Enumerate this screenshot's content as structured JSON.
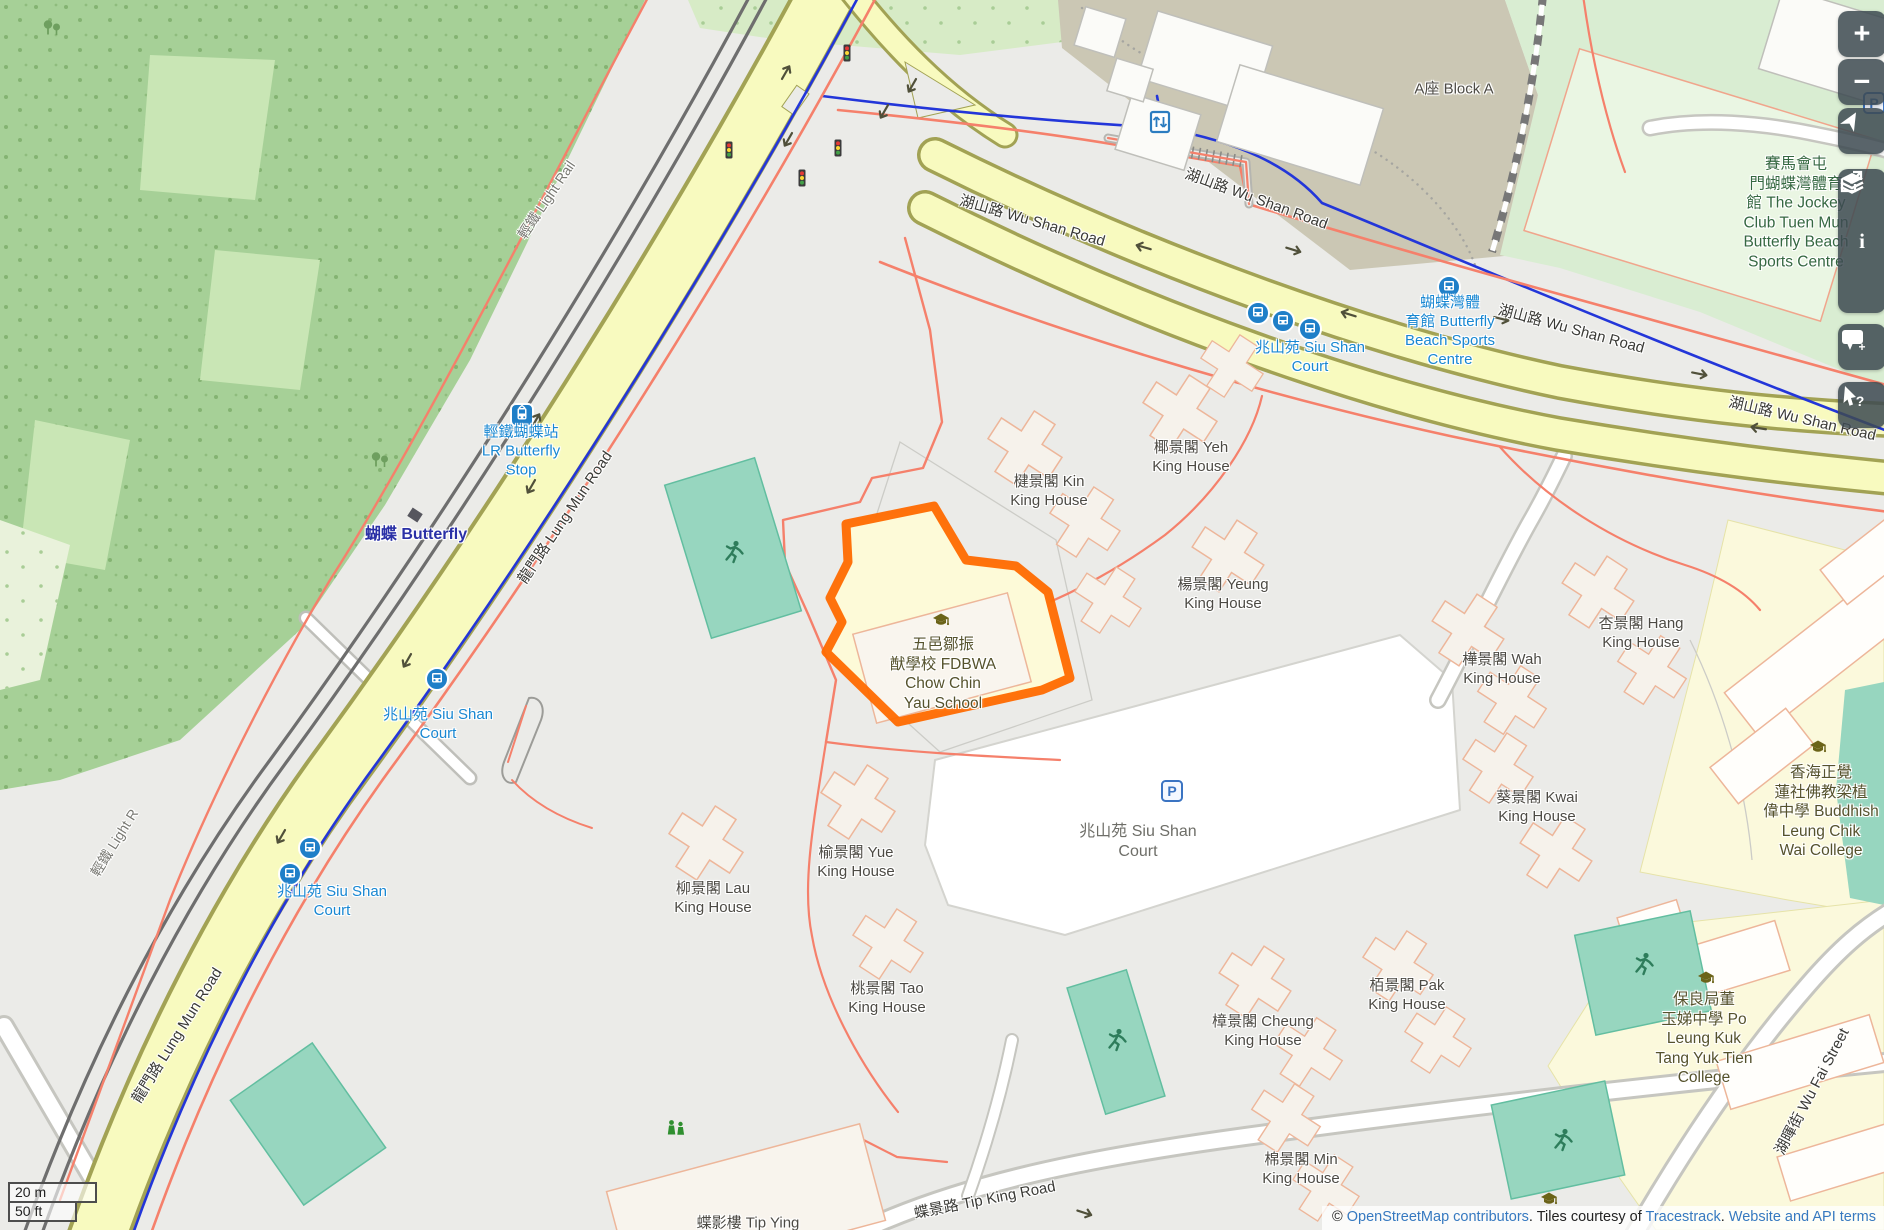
{
  "theme": {
    "transit-blue": "#1887D2",
    "link-blue": "#3679C0",
    "highlight-orange": "#FF6A00",
    "road-yellow": "#F8FABF",
    "pitch-teal": "#97D6BF"
  },
  "controls": {
    "zoom_in": "+",
    "zoom_out": "−",
    "info_glyph": "i",
    "comment_plus": "+",
    "query_glyph": "?"
  },
  "scalebar": {
    "metric": "20 m",
    "imperial": "50 ft"
  },
  "attribution": {
    "parts": [
      {
        "text": "© ",
        "link": false
      },
      {
        "text": "OpenStreetMap contributors",
        "link": true
      },
      {
        "text": ". Tiles courtesy of ",
        "link": false
      },
      {
        "text": "Tracestrack",
        "link": true
      },
      {
        "text": ". ",
        "link": false
      },
      {
        "text": "Website and API terms",
        "link": true
      }
    ]
  },
  "map": {
    "parking_glyph": "P",
    "labels": [
      {
        "name": "wu-shan-road-label-1",
        "cls": "road",
        "x": 1032,
        "y": 222,
        "rot": 16,
        "lines": [
          "湖山路 Wu Shan Road"
        ]
      },
      {
        "name": "wu-shan-road-label-2",
        "cls": "road",
        "x": 1256,
        "y": 200,
        "rot": 20,
        "lines": [
          "湖山路 Wu Shan Road"
        ]
      },
      {
        "name": "wu-shan-road-label-3",
        "cls": "road",
        "x": 1571,
        "y": 330,
        "rot": 15,
        "lines": [
          "湖山路 Wu Shan Road"
        ]
      },
      {
        "name": "wu-shan-road-label-4",
        "cls": "road",
        "x": 1802,
        "y": 420,
        "rot": 13,
        "lines": [
          "湖山路 Wu Shan Road"
        ]
      },
      {
        "name": "lung-mun-road-label-1",
        "cls": "road",
        "x": 566,
        "y": 518,
        "rot": -56,
        "lines": [
          "龍門路 Lung Mun Road"
        ]
      },
      {
        "name": "lung-mun-road-label-2",
        "cls": "road",
        "x": 178,
        "y": 1036,
        "rot": -58,
        "lines": [
          "龍門路 Lung Mun Road"
        ]
      },
      {
        "name": "tip-king-road-label",
        "cls": "road",
        "x": 985,
        "y": 1201,
        "rot": -11,
        "lines": [
          "蝶景路 Tip King Road"
        ]
      },
      {
        "name": "wu-fai-street-label",
        "cls": "road",
        "x": 1813,
        "y": 1092,
        "rot": -62,
        "lines": [
          "湖暉街 Wu Fai Street"
        ]
      },
      {
        "name": "light-rail-label-1",
        "cls": "rail",
        "x": 547,
        "y": 200,
        "rot": -56,
        "lines": [
          "輕鐵 Light Rail"
        ]
      },
      {
        "name": "light-rail-label-2",
        "cls": "rail",
        "x": 115,
        "y": 843,
        "rot": -58,
        "lines": [
          "輕鐵 Light R"
        ]
      },
      {
        "name": "lr-butterfly-stop-label",
        "cls": "transit",
        "x": 521,
        "y": 452,
        "rot": 0,
        "lines": [
          "輕鐵蝴蝶站",
          "LR Butterfly",
          "Stop"
        ]
      },
      {
        "name": "siu-shan-court-transit-label-1",
        "cls": "transit",
        "x": 1310,
        "y": 358,
        "rot": 0,
        "lines": [
          "兆山苑 Siu Shan",
          "Court"
        ]
      },
      {
        "name": "butterfly-beach-sports-transit-label",
        "cls": "transit",
        "x": 1450,
        "y": 332,
        "rot": 0,
        "lines": [
          "蝴蝶灣體",
          "育館 Butterfly",
          "Beach Sports",
          "Centre"
        ]
      },
      {
        "name": "siu-shan-court-transit-label-2",
        "cls": "transit",
        "x": 438,
        "y": 725,
        "rot": 0,
        "lines": [
          "兆山苑 Siu Shan",
          "Court"
        ]
      },
      {
        "name": "siu-shan-court-transit-label-3",
        "cls": "transit",
        "x": 332,
        "y": 902,
        "rot": 0,
        "lines": [
          "兆山苑 Siu Shan",
          "Court"
        ]
      },
      {
        "name": "butterfly-station-label",
        "cls": "station",
        "x": 416,
        "y": 535,
        "rot": 0,
        "lines": [
          "蝴蝶 Butterfly"
        ]
      },
      {
        "name": "kin-king-house-label",
        "cls": "building",
        "x": 1049,
        "y": 492,
        "rot": 0,
        "lines": [
          "楗景閣 Kin",
          "King House"
        ]
      },
      {
        "name": "yeh-king-house-label",
        "cls": "building",
        "x": 1191,
        "y": 458,
        "rot": 0,
        "lines": [
          "椰景閣 Yeh",
          "King House"
        ]
      },
      {
        "name": "yeung-king-house-label",
        "cls": "building",
        "x": 1223,
        "y": 595,
        "rot": 0,
        "lines": [
          "楊景閣 Yeung",
          "King House"
        ]
      },
      {
        "name": "wah-king-house-label",
        "cls": "building",
        "x": 1502,
        "y": 670,
        "rot": 0,
        "lines": [
          "樺景閣 Wah",
          "King House"
        ]
      },
      {
        "name": "hang-king-house-label",
        "cls": "building",
        "x": 1641,
        "y": 634,
        "rot": 0,
        "lines": [
          "杏景閣 Hang",
          "King House"
        ]
      },
      {
        "name": "kwai-king-house-label",
        "cls": "building",
        "x": 1537,
        "y": 808,
        "rot": 0,
        "lines": [
          "葵景閣 Kwai",
          "King House"
        ]
      },
      {
        "name": "lau-king-house-label",
        "cls": "building",
        "x": 713,
        "y": 899,
        "rot": 0,
        "lines": [
          "柳景閣 Lau",
          "King House"
        ]
      },
      {
        "name": "yue-king-house-label",
        "cls": "building",
        "x": 856,
        "y": 863,
        "rot": 0,
        "lines": [
          "榆景閣 Yue",
          "King House"
        ]
      },
      {
        "name": "tao-king-house-label",
        "cls": "building",
        "x": 887,
        "y": 999,
        "rot": 0,
        "lines": [
          "桃景閣 Tao",
          "King House"
        ]
      },
      {
        "name": "cheung-king-house-label",
        "cls": "building",
        "x": 1263,
        "y": 1032,
        "rot": 0,
        "lines": [
          "樟景閣 Cheung",
          "King House"
        ]
      },
      {
        "name": "pak-king-house-label",
        "cls": "building",
        "x": 1407,
        "y": 996,
        "rot": 0,
        "lines": [
          "栢景閣 Pak",
          "King House"
        ]
      },
      {
        "name": "min-king-house-label",
        "cls": "building",
        "x": 1301,
        "y": 1170,
        "rot": 0,
        "lines": [
          "棉景閣 Min",
          "King House"
        ]
      },
      {
        "name": "tip-ying-house-label",
        "cls": "building",
        "x": 748,
        "y": 1224,
        "rot": 0,
        "lines": [
          "蝶影樓 Tip Ying"
        ]
      },
      {
        "name": "block-a-label",
        "cls": "building",
        "x": 1454,
        "y": 90,
        "rot": 0,
        "lines": [
          "A座 Block A"
        ]
      },
      {
        "name": "siu-shan-court-estate-label",
        "cls": "estate",
        "x": 1138,
        "y": 842,
        "rot": 0,
        "lines": [
          "兆山苑 Siu Shan",
          "Court"
        ]
      },
      {
        "name": "jockey-club-sports-centre-label",
        "cls": "area",
        "x": 1796,
        "y": 213,
        "rot": 0,
        "lines": [
          "賽馬會屯",
          "門蝴蝶灣體育",
          "館 The Jockey",
          "Club Tuen Mun",
          "Butterfly Beach",
          "Sports Centre"
        ]
      },
      {
        "name": "fdbwa-school-label",
        "cls": "school",
        "x": 943,
        "y": 674,
        "rot": 0,
        "lines": [
          "五邑鄒振",
          "猷學校 FDBWA",
          "Chow Chin",
          "Yau School"
        ]
      },
      {
        "name": "buddhist-college-label",
        "cls": "school",
        "x": 1821,
        "y": 812,
        "rot": 0,
        "lines": [
          "香海正覺",
          "蓮社佛教梁植",
          "偉中學 Buddhish",
          "Leung Chik",
          "Wai College"
        ]
      },
      {
        "name": "po-leung-kuk-college-label",
        "cls": "school",
        "x": 1704,
        "y": 1039,
        "rot": 0,
        "lines": [
          "保良局董",
          "玉娣中學 Po",
          "Leung Kuk",
          "Tang Yuk Tien",
          "College"
        ]
      }
    ],
    "icons": [
      {
        "type": "tram-stop-icon",
        "x": 522,
        "y": 415
      },
      {
        "type": "bus-stop-icon",
        "x": 1258,
        "y": 313
      },
      {
        "type": "bus-stop-icon",
        "x": 1283,
        "y": 321
      },
      {
        "type": "bus-stop-icon",
        "x": 1310,
        "y": 329
      },
      {
        "type": "bus-stop-icon",
        "x": 1449,
        "y": 287
      },
      {
        "type": "bus-stop-icon",
        "x": 437,
        "y": 679
      },
      {
        "type": "bus-stop-icon",
        "x": 310,
        "y": 848
      },
      {
        "type": "bus-stop-icon",
        "x": 290,
        "y": 874
      },
      {
        "type": "elevator-icon",
        "x": 1160,
        "y": 122
      },
      {
        "type": "parking-icon",
        "x": 1172,
        "y": 791
      },
      {
        "type": "parking-icon",
        "x": 1874,
        "y": 103
      },
      {
        "type": "traffic-signal-icon",
        "x": 847,
        "y": 53
      },
      {
        "type": "traffic-signal-icon",
        "x": 729,
        "y": 150
      },
      {
        "type": "traffic-signal-icon",
        "x": 838,
        "y": 148
      },
      {
        "type": "traffic-signal-icon",
        "x": 802,
        "y": 178
      },
      {
        "type": "pitch-runner-icon",
        "x": 733,
        "y": 552
      },
      {
        "type": "pitch-runner-icon",
        "x": 1116,
        "y": 1040
      },
      {
        "type": "pitch-runner-icon",
        "x": 1643,
        "y": 964
      },
      {
        "type": "pitch-runner-icon",
        "x": 1562,
        "y": 1140
      },
      {
        "type": "playground-icon",
        "x": 676,
        "y": 1128
      },
      {
        "type": "tree-icon",
        "x": 52,
        "y": 28
      },
      {
        "type": "tree-icon",
        "x": 380,
        "y": 460
      },
      {
        "type": "school-icon",
        "x": 941,
        "y": 621
      },
      {
        "type": "school-icon",
        "x": 1818,
        "y": 748
      },
      {
        "type": "school-icon",
        "x": 1706,
        "y": 979
      },
      {
        "type": "school-icon",
        "x": 1549,
        "y": 1200
      },
      {
        "type": "platform-icon",
        "x": 415,
        "y": 515,
        "rot": 33
      }
    ],
    "arrows": [
      {
        "x": 786,
        "y": 72,
        "rot": -60
      },
      {
        "x": 912,
        "y": 86,
        "rot": 120
      },
      {
        "x": 884,
        "y": 112,
        "rot": 120
      },
      {
        "x": 788,
        "y": 140,
        "rot": 120
      },
      {
        "x": 1143,
        "y": 247,
        "rot": 196
      },
      {
        "x": 1348,
        "y": 314,
        "rot": 197
      },
      {
        "x": 1758,
        "y": 428,
        "rot": 189
      },
      {
        "x": 1294,
        "y": 250,
        "rot": 17
      },
      {
        "x": 1502,
        "y": 319,
        "rot": 14
      },
      {
        "x": 1700,
        "y": 374,
        "rot": 11
      },
      {
        "x": 536,
        "y": 420,
        "rot": -60
      },
      {
        "x": 531,
        "y": 487,
        "rot": 120
      },
      {
        "x": 407,
        "y": 661,
        "rot": 120
      },
      {
        "x": 281,
        "y": 837,
        "rot": 120
      },
      {
        "x": 1085,
        "y": 1213,
        "rot": 18
      }
    ]
  }
}
